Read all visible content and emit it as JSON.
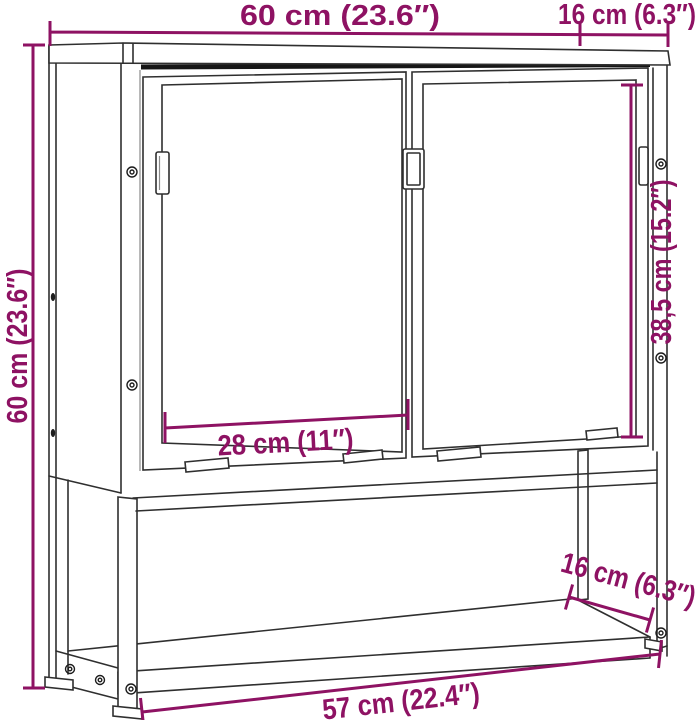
{
  "diagram": {
    "labels": {
      "overall_width": "60 cm (23.6″)",
      "overall_depth": "16 cm (6.3″)",
      "overall_height": "60 cm (23.6″)",
      "mirror_height": "38,5 cm (15.2″)",
      "door_width": "28 cm (11″)",
      "shelf_depth": "16 cm (6.3″)",
      "shelf_width": "57 cm (22.4″)"
    },
    "colors": {
      "dimension_accent": "#8e1263",
      "line_art": "#2f2f2f",
      "background": "#ffffff"
    }
  }
}
